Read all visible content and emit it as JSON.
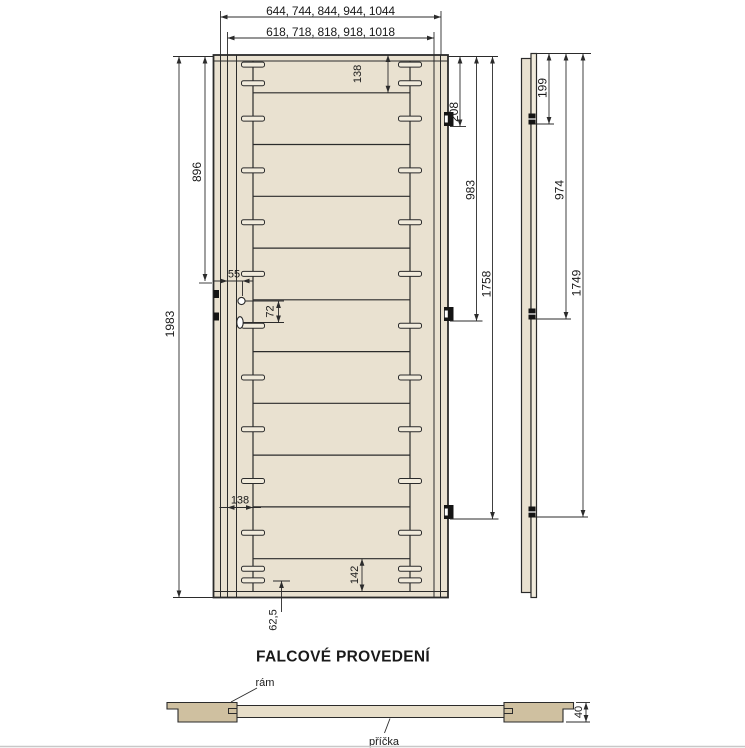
{
  "page": {
    "caption": "FALCOVÉ PROVEDENÍ"
  },
  "colors": {
    "line": "#2b2b2b",
    "text": "#1a1a1a",
    "door_face": "#e9e1d0",
    "tenon_fill": "#f1ebdc",
    "section_frame": "#cfc0a0",
    "section_strip": "#e7dec9",
    "hardware_black": "#141414",
    "page_rule": "#c8c8c8"
  },
  "front_view": {
    "dims": {
      "outer_widths": "644, 744, 844, 944, 1044",
      "leaf_widths": "618, 718, 818, 918, 1018",
      "height": "1983",
      "handle_height": "896",
      "handle_offset": "55",
      "handle_to_keyhole": "72",
      "top_rail_offset": "138",
      "stile_offset": "138",
      "bottom_rail_offset": "142",
      "bottom_dowel_offset": "62,5",
      "hinge_offsets": [
        "208",
        "983",
        "1758"
      ]
    }
  },
  "side_view": {
    "dims": {
      "hinge_offsets": [
        "199",
        "974",
        "1749"
      ]
    }
  },
  "section_view": {
    "dims": {
      "thickness": "40"
    },
    "labels": {
      "frame": "rám",
      "partition": "příčka"
    }
  }
}
